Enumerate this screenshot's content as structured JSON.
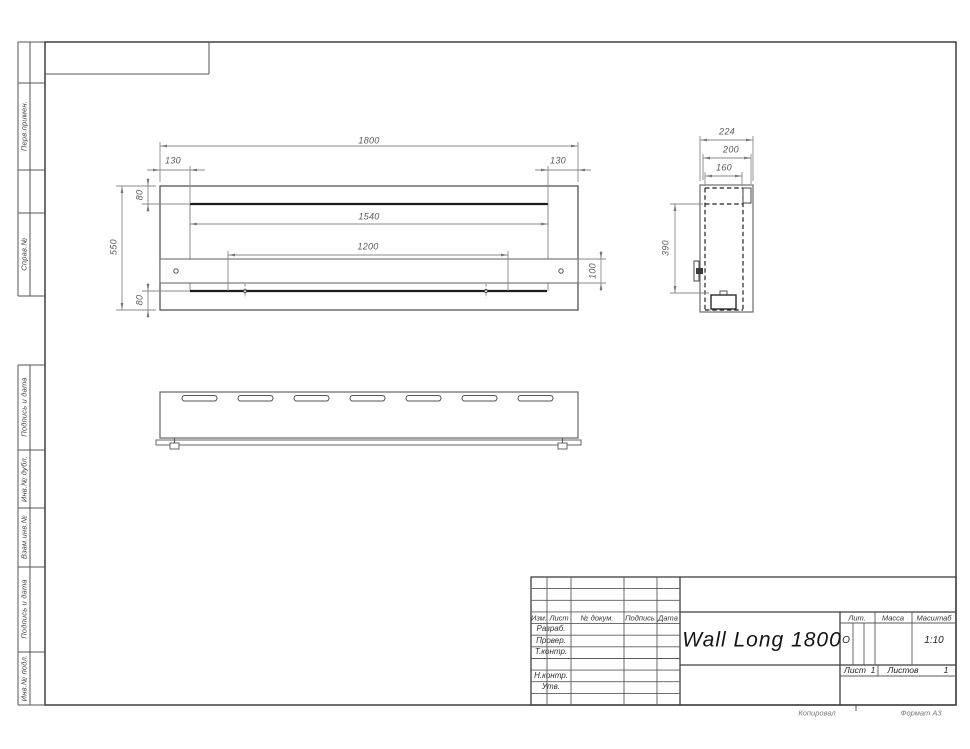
{
  "doc": {
    "title": "Wall Long 1800",
    "scale": "1:10",
    "format": "Формат А3",
    "copied": "Копировал",
    "litera": "О",
    "sheet_no": "1",
    "sheets_total": "1"
  },
  "margin": {
    "labels": [
      "Перв.примен.",
      "Справ.№",
      "Подпись и дата",
      "Инв.№ дубл.",
      "Взам.инв.№",
      "Подпись и дата",
      "Инв.№ подл."
    ]
  },
  "title_block": {
    "cols": {
      "izm": "Изм.",
      "list": "Лист",
      "doc_no": "№ докум.",
      "sign": "Подпись",
      "date": "Дата"
    },
    "roles": {
      "razrab": "Разраб.",
      "prover": "Провер.",
      "tkontr": "Т.контр.",
      "nkontr": "Н.контр.",
      "utv": "Утв."
    },
    "lit_label": "Лит.",
    "mass_label": "Масса",
    "scale_label": "Масштаб",
    "sheet_label": "Лист",
    "sheets_label": "Листов"
  },
  "dims": {
    "overall_width": "1800",
    "left_inset": "130",
    "right_inset": "130",
    "inner_width": "1540",
    "mount_span": "1200",
    "height": "550",
    "top_flange": "80",
    "bottom_flange": "80",
    "bracket_height": "100",
    "depth": "224",
    "depth_step": "200",
    "inner_depth": "160",
    "side_height": "390"
  }
}
